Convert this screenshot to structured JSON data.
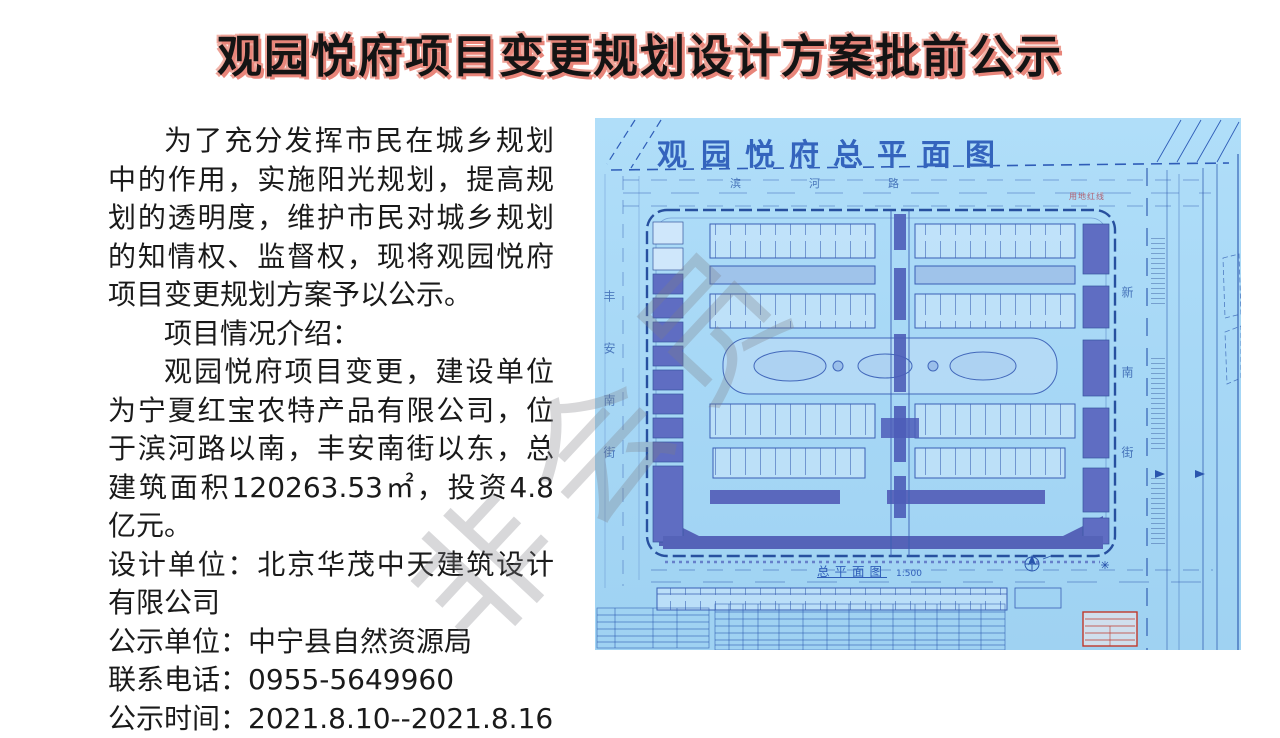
{
  "title": {
    "text": "观园悦府项目变更规划设计方案批前公示",
    "color": "#141414",
    "shadow_color": "#e8857a"
  },
  "body": {
    "para_intro": "为了充分发挥市民在城乡规划中的作用，实施阳光规划，提高规划的透明度，维护市民对城乡规划的知情权、监督权，现将观园悦府项目变更规划方案予以公示。",
    "section_heading": "项目情况介绍：",
    "para_project": "观园悦府项目变更，建设单位为宁夏红宝农特产品有限公司，位于滨河路以南，丰安南街以东，总建筑面积120263.53㎡，投资4.8亿元。",
    "design_unit": "设计单位：北京华茂中天建筑设计有限公司",
    "notice_unit": "公示单位：中宁县自然资源局",
    "phone": "联系电话：0955-5649960",
    "period": "公示时间：2021.8.10--2021.8.16"
  },
  "watermark": {
    "text": "非会员",
    "color": "rgba(125,125,132,0.30)"
  },
  "blueprint": {
    "title": "观园悦府总平面图",
    "road_north": "滨河路",
    "road_west": "丰安南街",
    "road_east": "新南街",
    "boundary_label": "用地红线",
    "caption": "总平面图",
    "caption_scale": "1:500",
    "colors": {
      "paper": "#a7d8f6",
      "line": "#2f5db8",
      "building": "#5f6dc2",
      "stamp_red": "#c0392b"
    }
  }
}
